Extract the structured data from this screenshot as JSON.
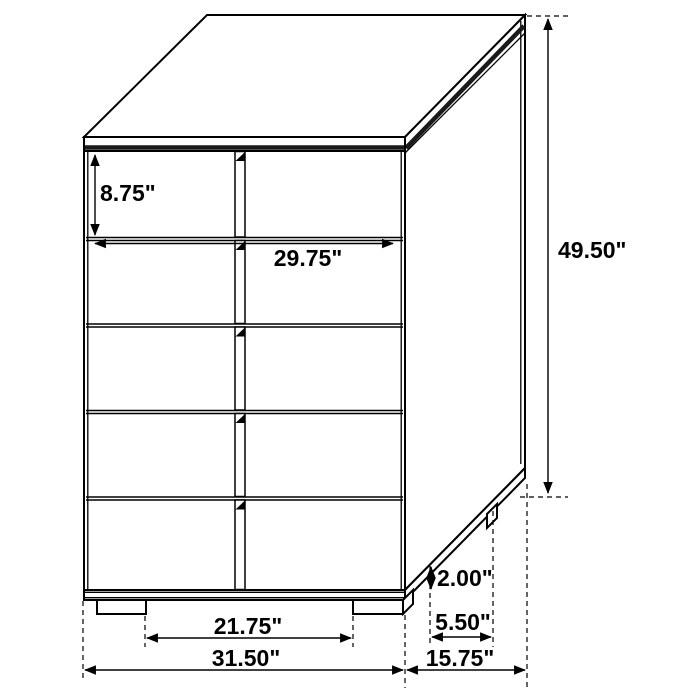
{
  "diagram": {
    "figure": "chest-of-drawers-dimension-diagram",
    "background": "#ffffff",
    "line_color": "#000000",
    "drawer_rows": 5,
    "labels": {
      "drawer_height": "8.75\"",
      "drawer_width": "29.75\"",
      "overall_height": "49.50\"",
      "leg_height": "2.00\"",
      "side_leg_spacing": "5.50\"",
      "front_leg_spacing": "21.75\"",
      "overall_width": "31.50\"",
      "overall_depth": "15.75\""
    }
  }
}
